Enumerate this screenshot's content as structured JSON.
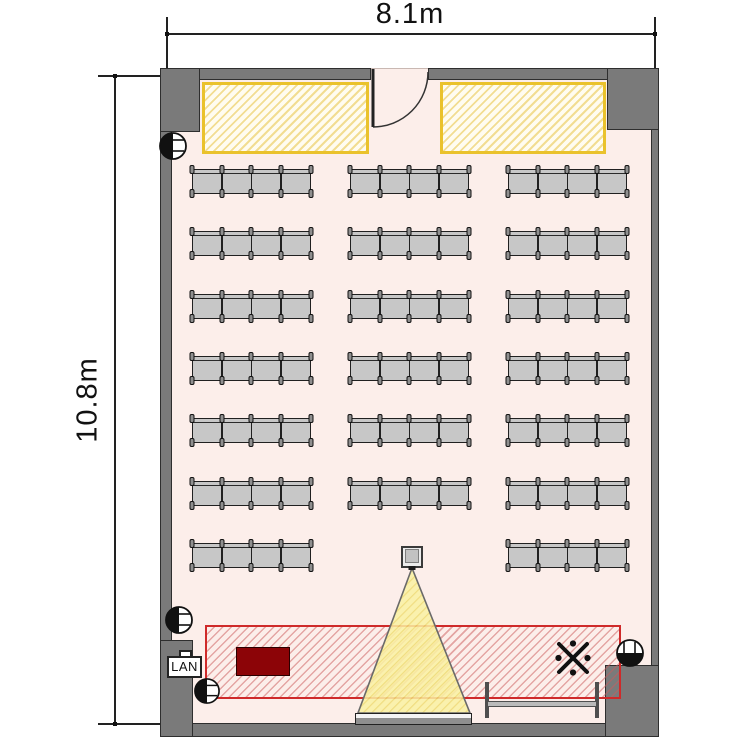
{
  "dimensions": {
    "width_label": "8.1m",
    "height_label": "10.8m"
  },
  "equipment": {
    "lan_label": "LAN",
    "reference_mark": "※"
  },
  "seating": {
    "chairs_per_group": 4,
    "rows": [
      {
        "groups": [
          "left",
          "center",
          "right"
        ]
      },
      {
        "groups": [
          "left",
          "center",
          "right"
        ]
      },
      {
        "groups": [
          "left",
          "center",
          "right"
        ]
      },
      {
        "groups": [
          "left",
          "center",
          "right"
        ]
      },
      {
        "groups": [
          "left",
          "center",
          "right"
        ]
      },
      {
        "groups": [
          "left",
          "center",
          "right"
        ]
      },
      {
        "groups": [
          "left",
          "right"
        ]
      }
    ],
    "total_chairs": 80
  },
  "icons": {
    "reference_mark": "kome-jirushi ※ (X cross with four dots)",
    "outlet": "half-filled circle electrical outlet symbol",
    "door": "quarter-arc swing door",
    "projector": "square projector head with beam cone",
    "lan_port": "LAN wall port"
  },
  "colors": {
    "floor": "#fceeea",
    "wall": "#7a7a7a",
    "table_border": "#eac22c",
    "table_hatch": "#f2dd92",
    "stage_zone_border": "#cf2a2a",
    "podium": "#8c0407",
    "beam_fill": "#faf2a2",
    "chair": "#c7c7c7"
  }
}
